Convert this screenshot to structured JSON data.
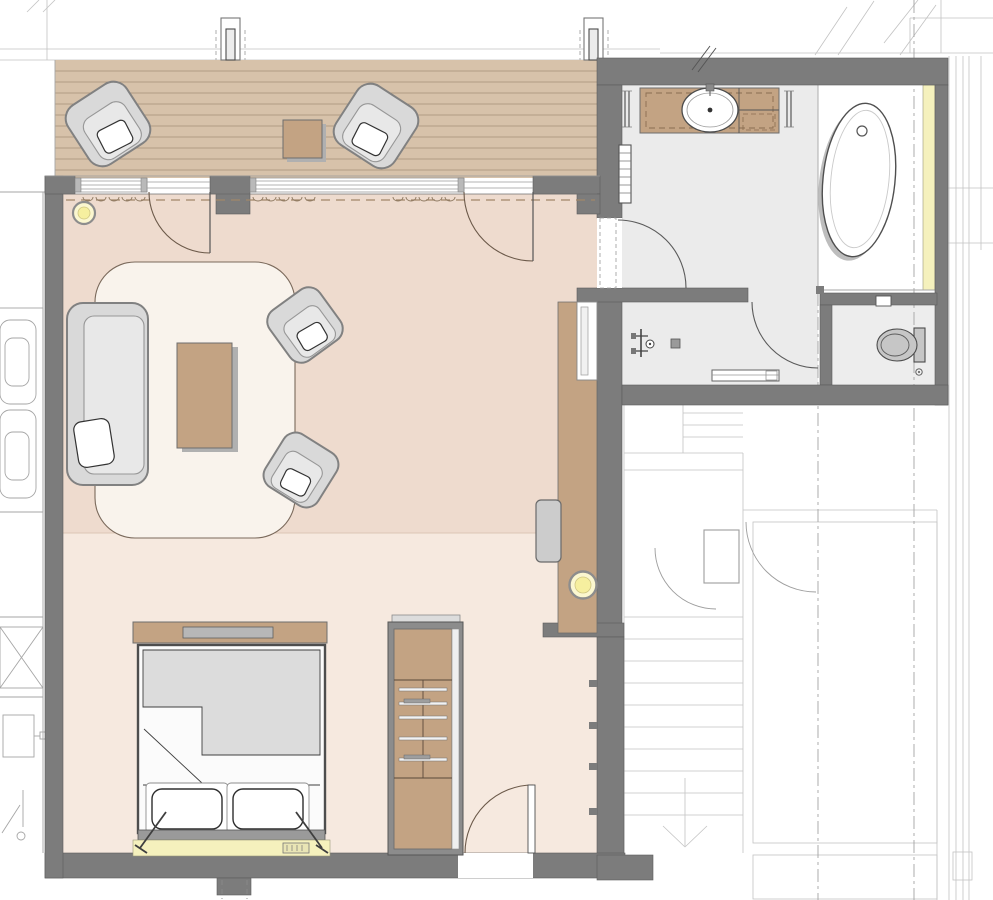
{
  "document": {
    "type": "architectural-floor-plan",
    "view": "top-down rendered color plan",
    "description": "Hotel-suite floor plan: wood terrace with lounge chairs, living area with sofa group, sleeping area with double bed and wardrobe, bathroom with vanity, freestanding bathtub, shower and separate WC, adjacent stair hall with elevator shafts"
  },
  "colors": {
    "wall": "#7c7c7c",
    "wallEdge": "#5c5c5c",
    "floorLiving": "#eedbce",
    "floorSleeping": "#f6e9df",
    "terraceWood": "#d7c2aa",
    "plankLine": "#b19c84",
    "floorBath": "#ebebeb",
    "floorWc": "#ededed",
    "accentYellow": "#f5f1bd",
    "lightYellow": "#f6ef9f",
    "furnitureGray": "#d9d9d9",
    "furnitureEdge": "#818181",
    "woodBrown": "#c3a383",
    "rug": "#f9f3ec",
    "duvet": "#dcdcdc",
    "shadow": "#b0b0b0",
    "annotation": "#a6a6a6",
    "doorArc": "#6b5949",
    "dashBrown": "#a1876a"
  },
  "rooms": {
    "terrace": {
      "label": "terrace",
      "floor": "wood-deck",
      "items": [
        "lounge-chair",
        "lounge-chair",
        "side-table",
        "structural-post",
        "structural-post"
      ]
    },
    "living_area": {
      "label": "living-area",
      "floor": "rose-screed",
      "items": [
        "sofa",
        "coffee-table",
        "armchair",
        "armchair",
        "area-rug",
        "ceiling-light",
        "wall-console",
        "luggage-bench",
        "ceiling-light"
      ]
    },
    "sleeping_area": {
      "label": "sleeping-area",
      "floor": "light-rose-screed",
      "items": [
        "double-bed",
        "duvet",
        "pillow",
        "pillow",
        "footboard-shelf",
        "headboard-light-strip",
        "reading-lamp",
        "reading-lamp",
        "wardrobe"
      ]
    },
    "bathroom": {
      "label": "bathroom",
      "floor": "gray-tile",
      "items": [
        "vanity-washbasin",
        "towel-rail",
        "towel-rail",
        "towel-radiator",
        "freestanding-bathtub",
        "tub-niche-light-cove",
        "shower-valve",
        "floor-drain",
        "bench"
      ]
    },
    "wc": {
      "label": "wc",
      "floor": "gray-tile",
      "items": [
        "toilet",
        "flush-plate",
        "floor-drain"
      ]
    },
    "stair_hall": {
      "label": "stair-hall",
      "items": [
        "staircase",
        "walk-line-arrow",
        "landing",
        "elevator-shaft",
        "elevator-shaft",
        "door-leaf"
      ]
    },
    "adjacent_unit": {
      "label": "adjacent-unit-outline",
      "items": [
        "lounge-chair",
        "lounge-chair",
        "shaft-box",
        "appliance",
        "door-swing"
      ]
    }
  },
  "doors": [
    "terrace-door-left",
    "terrace-door-right",
    "suite-entry-door",
    "bathroom-door",
    "shower-wc-door",
    "stair-door",
    "stair-door"
  ],
  "annotations": [
    "section-line-dashdot-x818",
    "section-line-dashdot-x914",
    "roof-slope-diagonals",
    "wall-break-mark",
    "threshold-dashes",
    "window-curtain-scallops"
  ]
}
